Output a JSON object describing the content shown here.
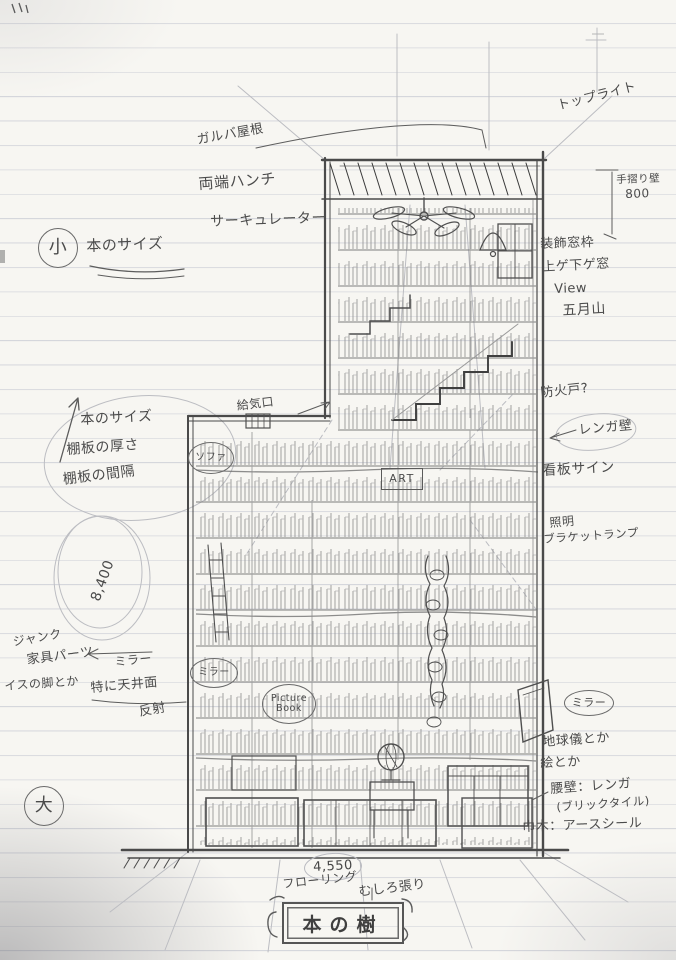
{
  "colors": {
    "paper": "#f7f6f2",
    "rule_line": "#ccced6",
    "pencil": "#5a5a5a",
    "pencil_dark": "#3e3e3e",
    "pencil_light": "#b5b5b5"
  },
  "notes": {
    "size_small_mark": "小",
    "size_small": "本のサイズ",
    "galba_roof": "ガルバ屋根",
    "haunch": "両端ハンチ",
    "circulator": "サーキュレーター",
    "toplight": "トップライト",
    "handrail_wall": "手摺り壁",
    "dim_800": "800",
    "deco_window": "装飾窓枠",
    "sash_window": "上ゲ下ゲ窓",
    "view": "View",
    "satsukiyama": "五月山",
    "fire_door": "防火戸?",
    "brick_wall": "レンガ壁",
    "signboard": "看板サイン",
    "lighting": "照明",
    "bracket_lamp": "ブラケットランプ",
    "book_size": "本のサイズ",
    "shelf_thickness": "棚板の厚さ",
    "shelf_spacing": "棚板の間隔",
    "air_inlet": "給気口",
    "sofa": "ソファ",
    "art": "ART",
    "dim_8400": "8,400",
    "junk": "ジャンク",
    "furniture_parts": "家具パーツ",
    "chair_legs": "イスの脚とか",
    "mirror_note": "ミラー",
    "esp_ceiling": "特に天井面",
    "reflection": "反射",
    "mirror_label": "ミラー",
    "size_large_mark": "大",
    "picture_book": "Picture Book",
    "mirror_right": "ミラー",
    "globe_etc": "地球儀とか",
    "paintings_etc": "絵とか",
    "waist_wall": "腰壁：レンガ",
    "brick_tile": "(ブリックタイル)",
    "baseboard": "巾木：アースシール",
    "dim_4550": "4,550",
    "flooring": "フローリング",
    "mushiro": "むしろ張り",
    "title": "本の樹"
  }
}
